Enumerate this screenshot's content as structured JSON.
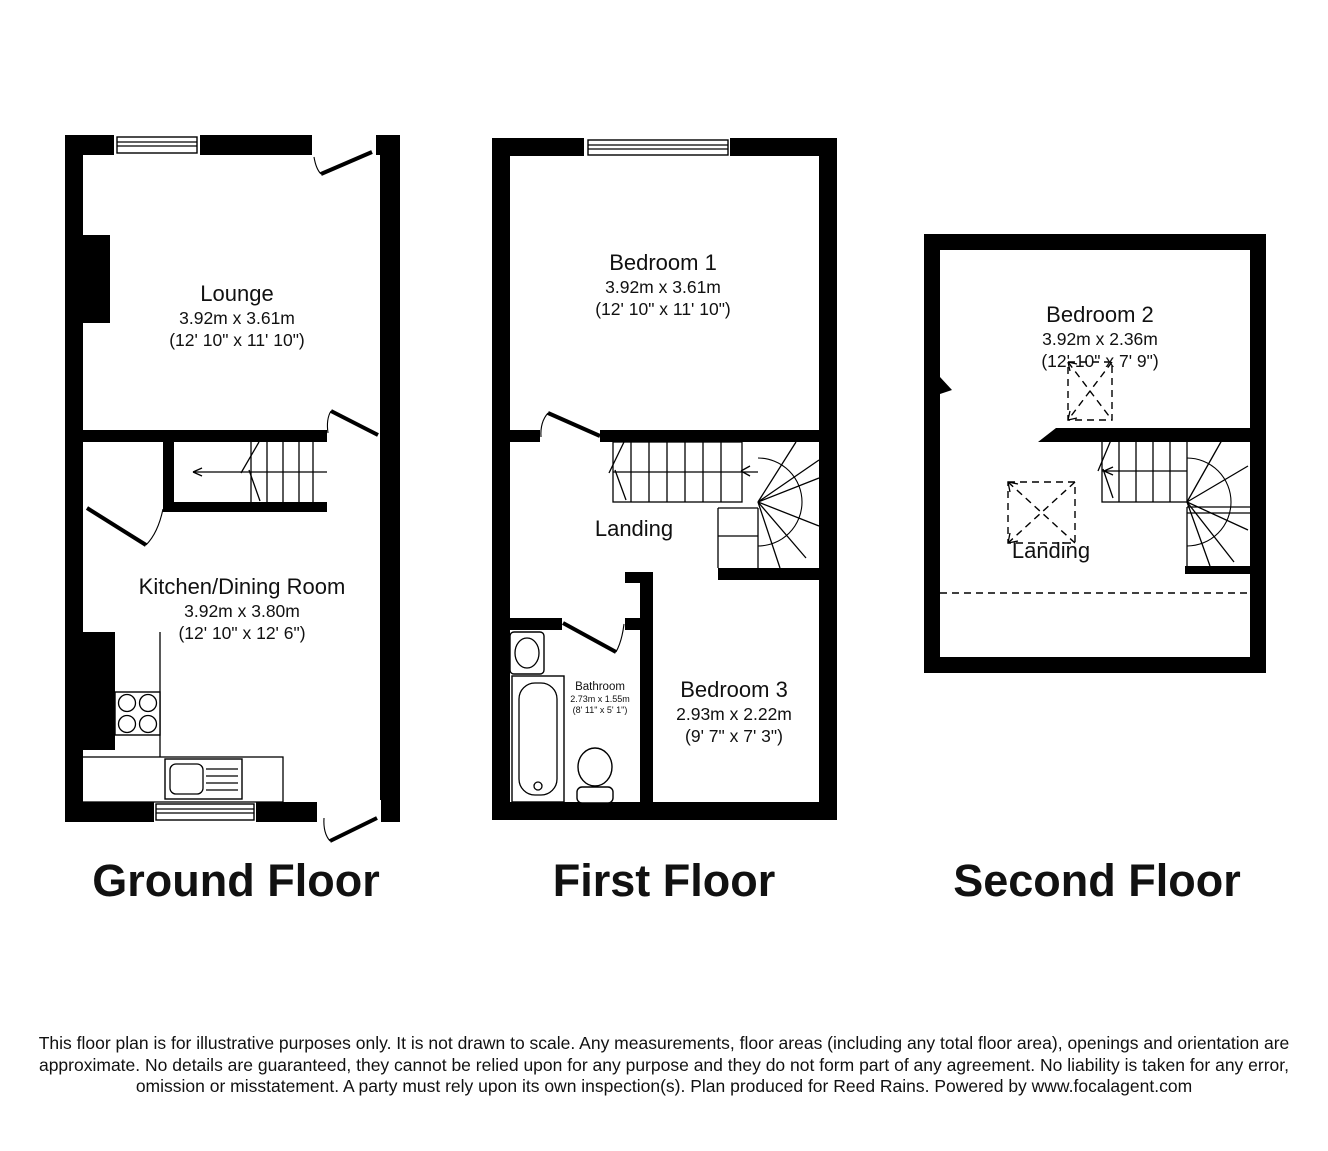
{
  "colors": {
    "wall": "#000000",
    "background": "#ffffff",
    "text": "#111111"
  },
  "floors": {
    "ground": {
      "label": "Ground Floor",
      "rooms": {
        "lounge": {
          "name": "Lounge",
          "metric": "3.92m x 3.61m",
          "imperial": "(12' 10\" x 11' 10\")"
        },
        "kitchen_dining": {
          "name": "Kitchen/Dining Room",
          "metric": "3.92m x 3.80m",
          "imperial": "(12' 10\" x 12' 6\")"
        }
      }
    },
    "first": {
      "label": "First Floor",
      "rooms": {
        "bedroom1": {
          "name": "Bedroom 1",
          "metric": "3.92m x 3.61m",
          "imperial": "(12' 10\" x 11' 10\")"
        },
        "landing": {
          "name": "Landing"
        },
        "bathroom": {
          "name": "Bathroom",
          "metric": "2.73m x 1.55m",
          "imperial": "(8' 11\" x 5' 1\")"
        },
        "bedroom3": {
          "name": "Bedroom 3",
          "metric": "2.93m x 2.22m",
          "imperial": "(9' 7\" x 7' 3\")"
        }
      }
    },
    "second": {
      "label": "Second Floor",
      "rooms": {
        "bedroom2": {
          "name": "Bedroom 2",
          "metric": "3.92m x 2.36m",
          "imperial": "(12' 10\" x 7' 9\")"
        },
        "landing": {
          "name": "Landing"
        }
      }
    }
  },
  "disclaimer": "This floor plan is for illustrative purposes only. It is not drawn to scale. Any measurements, floor areas (including any total floor area), openings and orientation are approximate. No details are guaranteed, they cannot be relied upon for any purpose and they do not form part of any agreement. No liability is taken for any error, omission or misstatement. A party must rely upon its own inspection(s). Plan produced for Reed Rains. Powered by www.focalagent.com"
}
